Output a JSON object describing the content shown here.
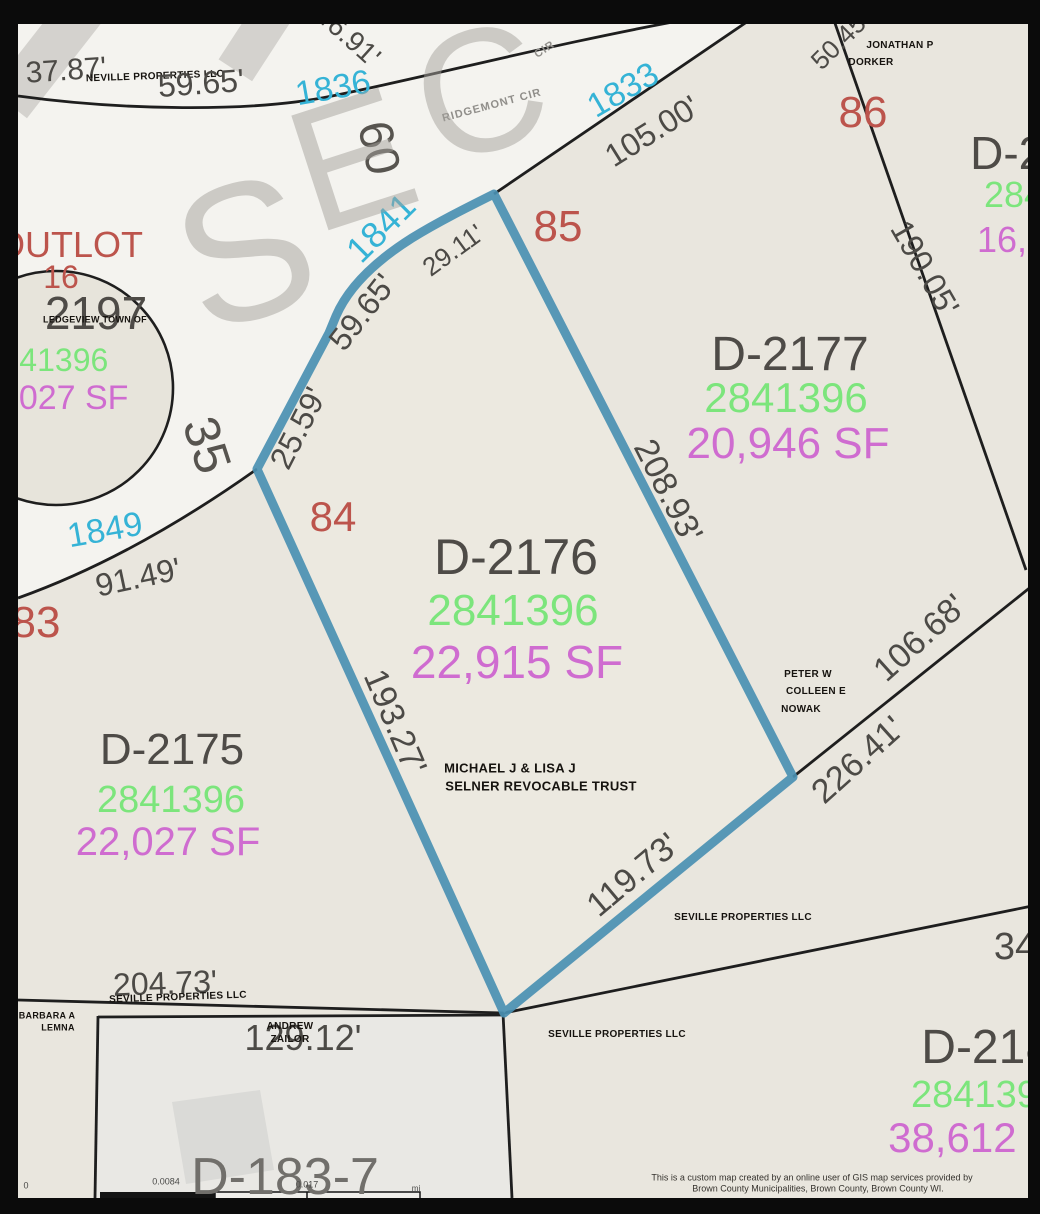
{
  "map": {
    "street_name": "RIDGEMONT CIR",
    "highlighted_parcel": {
      "id": "D-2176",
      "pin": "2841396",
      "area": "22,915 SF",
      "lot_number": "84",
      "owner": "MICHAEL J & LISA J SELNER REVOCABLE TRUST"
    },
    "palette": {
      "highlight_blue": "#4a90b2",
      "lot_number_red": "#bc544c",
      "house_number_cyan": "#35b3d6",
      "pin_green": "#7ce57c",
      "area_magenta": "#cf6cd0",
      "parcel_gray": "#4e4b47",
      "road_white": "#f4f3ef",
      "parcel_beige": "#e9e6de",
      "boundary_black": "#1e1e1e"
    },
    "labels": [
      {
        "t": "37.87'",
        "x": 66,
        "y": 71,
        "r": -4,
        "s": 30,
        "c": "dim"
      },
      {
        "t": "NEVILLE PROPERTIES LLC",
        "x": 155,
        "y": 77,
        "r": -2,
        "s": 10,
        "c": "owner"
      },
      {
        "t": "59.65'",
        "x": 201,
        "y": 83,
        "r": -4,
        "s": 32,
        "c": "dim"
      },
      {
        "t": "46.91'",
        "x": 348,
        "y": 36,
        "r": 42,
        "s": 28,
        "c": "dim"
      },
      {
        "t": "1836",
        "x": 333,
        "y": 88,
        "r": -10,
        "s": 34,
        "c": "cyan"
      },
      {
        "t": "60",
        "x": 378,
        "y": 148,
        "r": 78,
        "s": 48,
        "c": "dim2"
      },
      {
        "t": "RIDGEMONT CIR",
        "x": 492,
        "y": 106,
        "r": -15,
        "s": 11,
        "c": "road"
      },
      {
        "t": "CIR",
        "x": 545,
        "y": 50,
        "r": -33,
        "s": 11,
        "c": "road"
      },
      {
        "t": "1833",
        "x": 623,
        "y": 90,
        "r": -30,
        "s": 34,
        "c": "cyan"
      },
      {
        "t": "105.00'",
        "x": 652,
        "y": 131,
        "r": -32,
        "s": 32,
        "c": "dim"
      },
      {
        "t": "50.45'",
        "x": 840,
        "y": 40,
        "r": -45,
        "s": 26,
        "c": "dim"
      },
      {
        "t": "JONATHAN P",
        "x": 900,
        "y": 46,
        "r": 0,
        "s": 10,
        "c": "owner"
      },
      {
        "t": "DORKER",
        "x": 871,
        "y": 63,
        "r": 0,
        "s": 10,
        "c": "owner"
      },
      {
        "t": "86",
        "x": 863,
        "y": 113,
        "r": 0,
        "s": 44,
        "c": "red"
      },
      {
        "t": "D-21",
        "x": 1020,
        "y": 153,
        "r": 0,
        "s": 46,
        "c": "id"
      },
      {
        "t": "2841",
        "x": 1024,
        "y": 195,
        "r": 0,
        "s": 36,
        "c": "green"
      },
      {
        "t": "16,64",
        "x": 1022,
        "y": 240,
        "r": 0,
        "s": 36,
        "c": "magenta"
      },
      {
        "t": "190.05'",
        "x": 925,
        "y": 268,
        "r": 60,
        "s": 32,
        "c": "dim"
      },
      {
        "t": "85",
        "x": 558,
        "y": 227,
        "r": 0,
        "s": 44,
        "c": "red"
      },
      {
        "t": "1841",
        "x": 381,
        "y": 228,
        "r": -45,
        "s": 36,
        "c": "cyan"
      },
      {
        "t": "29.11'",
        "x": 453,
        "y": 250,
        "r": -36,
        "s": 26,
        "c": "dim"
      },
      {
        "t": "59.65'",
        "x": 362,
        "y": 312,
        "r": -52,
        "s": 32,
        "c": "dim"
      },
      {
        "t": "25.59'",
        "x": 298,
        "y": 428,
        "r": -63,
        "s": 32,
        "c": "dim"
      },
      {
        "t": "35",
        "x": 207,
        "y": 445,
        "r": 72,
        "s": 50,
        "c": "dim2"
      },
      {
        "t": "OUTLOT",
        "x": 70,
        "y": 245,
        "r": 0,
        "s": 36,
        "c": "red"
      },
      {
        "t": "16",
        "x": 61,
        "y": 277,
        "r": 0,
        "s": 32,
        "c": "red"
      },
      {
        "t": "2197",
        "x": 96,
        "y": 313,
        "r": 0,
        "s": 46,
        "c": "id"
      },
      {
        "t": "LEDGEVIEW TOWN OF",
        "x": 95,
        "y": 320,
        "r": 0,
        "s": 9,
        "c": "owner"
      },
      {
        "t": "2841396",
        "x": 46,
        "y": 360,
        "r": 0,
        "s": 32,
        "c": "green"
      },
      {
        "t": "22,027 SF",
        "x": 50,
        "y": 398,
        "r": 0,
        "s": 34,
        "c": "magenta"
      },
      {
        "t": "1849",
        "x": 105,
        "y": 530,
        "r": -10,
        "s": 34,
        "c": "cyan"
      },
      {
        "t": "91.49'",
        "x": 138,
        "y": 577,
        "r": -12,
        "s": 32,
        "c": "dim"
      },
      {
        "t": "83",
        "x": 36,
        "y": 623,
        "r": 0,
        "s": 44,
        "c": "red"
      },
      {
        "t": "84",
        "x": 333,
        "y": 517,
        "r": 0,
        "s": 42,
        "c": "red"
      },
      {
        "t": "D-2175",
        "x": 172,
        "y": 750,
        "r": 0,
        "s": 44,
        "c": "id"
      },
      {
        "t": "2841396",
        "x": 171,
        "y": 800,
        "r": 0,
        "s": 38,
        "c": "green"
      },
      {
        "t": "22,027 SF",
        "x": 168,
        "y": 842,
        "r": 0,
        "s": 40,
        "c": "magenta"
      },
      {
        "t": "D-2176",
        "x": 516,
        "y": 557,
        "r": 0,
        "s": 50,
        "c": "id"
      },
      {
        "t": "2841396",
        "x": 513,
        "y": 611,
        "r": 0,
        "s": 44,
        "c": "green"
      },
      {
        "t": "22,915 SF",
        "x": 517,
        "y": 662,
        "r": 0,
        "s": 46,
        "c": "magenta"
      },
      {
        "t": "193.27'",
        "x": 395,
        "y": 722,
        "r": 67,
        "s": 34,
        "c": "dim"
      },
      {
        "t": "MICHAEL J & LISA J",
        "x": 510,
        "y": 768,
        "r": 0,
        "s": 13,
        "c": "owner"
      },
      {
        "t": "SELNER REVOCABLE TRUST",
        "x": 541,
        "y": 786,
        "r": 0,
        "s": 13,
        "c": "owner"
      },
      {
        "t": "D-2177",
        "x": 790,
        "y": 355,
        "r": 0,
        "s": 48,
        "c": "id"
      },
      {
        "t": "2841396",
        "x": 786,
        "y": 398,
        "r": 0,
        "s": 42,
        "c": "green"
      },
      {
        "t": "20,946 SF",
        "x": 788,
        "y": 444,
        "r": 0,
        "s": 44,
        "c": "magenta"
      },
      {
        "t": "208.93'",
        "x": 668,
        "y": 491,
        "r": 63,
        "s": 34,
        "c": "dim"
      },
      {
        "t": "PETER W",
        "x": 808,
        "y": 675,
        "r": 0,
        "s": 10,
        "c": "owner"
      },
      {
        "t": "COLLEEN E",
        "x": 816,
        "y": 692,
        "r": 0,
        "s": 10,
        "c": "owner"
      },
      {
        "t": "NOWAK",
        "x": 801,
        "y": 710,
        "r": 0,
        "s": 10,
        "c": "owner"
      },
      {
        "t": "106.68'",
        "x": 920,
        "y": 638,
        "r": -42,
        "s": 34,
        "c": "dim"
      },
      {
        "t": "226.41'",
        "x": 858,
        "y": 760,
        "r": -42,
        "s": 34,
        "c": "dim"
      },
      {
        "t": "119.73'",
        "x": 633,
        "y": 875,
        "r": -40,
        "s": 34,
        "c": "dim"
      },
      {
        "t": "SEVILLE PROPERTIES LLC",
        "x": 743,
        "y": 918,
        "r": 0,
        "s": 10,
        "c": "owner"
      },
      {
        "t": "34",
        "x": 1015,
        "y": 947,
        "r": 0,
        "s": 38,
        "c": "dim"
      },
      {
        "t": "204.73'",
        "x": 165,
        "y": 983,
        "r": -2,
        "s": 32,
        "c": "dim"
      },
      {
        "t": "SEVILLE PROPERTIES LLC",
        "x": 178,
        "y": 998,
        "r": -2,
        "s": 10,
        "c": "owner"
      },
      {
        "t": "BARBARA A",
        "x": 47,
        "y": 1016,
        "r": 0,
        "s": 9,
        "c": "owner"
      },
      {
        "t": "LEMNA",
        "x": 58,
        "y": 1028,
        "r": 0,
        "s": 9,
        "c": "owner"
      },
      {
        "t": "129.12'",
        "x": 303,
        "y": 1038,
        "r": 0,
        "s": 36,
        "c": "dim"
      },
      {
        "t": "ANDREW",
        "x": 290,
        "y": 1027,
        "r": 0,
        "s": 10,
        "c": "owner"
      },
      {
        "t": "ZAILOR",
        "x": 290,
        "y": 1040,
        "r": 0,
        "s": 10,
        "c": "owner"
      },
      {
        "t": "SEVILLE PROPERTIES LLC",
        "x": 617,
        "y": 1035,
        "r": 0,
        "s": 10,
        "c": "owner"
      },
      {
        "t": "D-2183",
        "x": 1000,
        "y": 1048,
        "r": 0,
        "s": 48,
        "c": "id"
      },
      {
        "t": "2841396",
        "x": 985,
        "y": 1095,
        "r": 0,
        "s": 38,
        "c": "green"
      },
      {
        "t": "38,612 SF",
        "x": 985,
        "y": 1138,
        "r": 0,
        "s": 42,
        "c": "magenta"
      },
      {
        "t": "D-183-7",
        "x": 285,
        "y": 1177,
        "r": 0,
        "s": 52,
        "c": "id2"
      },
      {
        "t": "0",
        "x": 26,
        "y": 1186,
        "r": 0,
        "s": 9,
        "c": "scale"
      },
      {
        "t": "0.0084",
        "x": 166,
        "y": 1182,
        "r": 0,
        "s": 9,
        "c": "scale"
      },
      {
        "t": "0.017",
        "x": 307,
        "y": 1185,
        "r": 0,
        "s": 9,
        "c": "scale"
      },
      {
        "t": "mi",
        "x": 416,
        "y": 1189,
        "r": 0,
        "s": 8,
        "c": "scale"
      },
      {
        "t": "S",
        "x": 245,
        "y": 252,
        "r": -18,
        "s": 195,
        "c": "wm"
      },
      {
        "t": "E",
        "x": 352,
        "y": 160,
        "r": -18,
        "s": 175,
        "c": "wm"
      },
      {
        "t": "C",
        "x": 480,
        "y": 92,
        "r": -18,
        "s": 175,
        "c": "wm"
      },
      {
        "t": "This is a custom map created by an online user of GIS map services provided by",
        "x": 812,
        "y": 1178,
        "r": 0,
        "s": 9,
        "c": "disc"
      },
      {
        "t": "Brown County Municipalities, Brown County, Brown County WI.",
        "x": 818,
        "y": 1189,
        "r": 0,
        "s": 9,
        "c": "disc"
      }
    ]
  }
}
